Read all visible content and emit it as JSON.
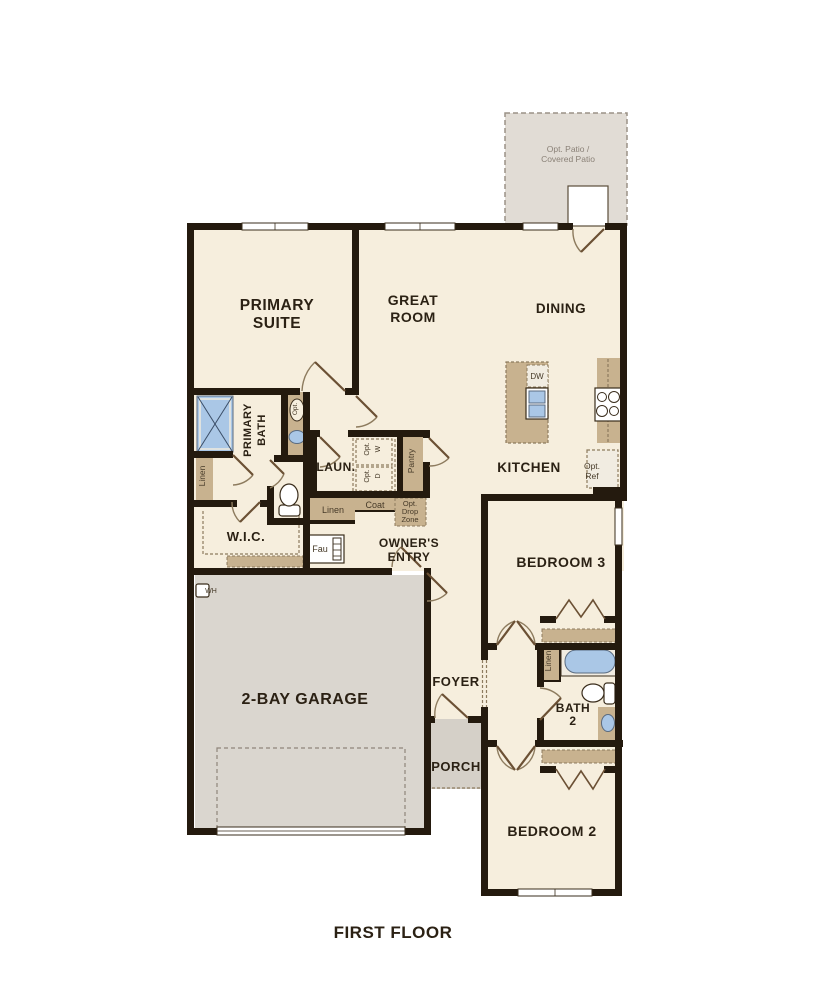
{
  "title": "FIRST FLOOR",
  "colors": {
    "wall": "#241a0e",
    "room_floor": "#f6eedd",
    "garage_floor": "#dad6cf",
    "porch_floor": "#d5d0c8",
    "patio_floor": "#e1dcd5",
    "cabinet_tan": "#c8b28f",
    "fixture_blue": "#aac7e6",
    "label_text": "#2b2114"
  },
  "labels": {
    "patio1": "Opt. Patio /",
    "patio2": "Covered Patio",
    "primary_suite1": "PRIMARY",
    "primary_suite2": "SUITE",
    "great_room1": "GREAT",
    "great_room2": "ROOM",
    "dining": "DINING",
    "kitchen": "KITCHEN",
    "primary_bath1": "PRIMARY",
    "primary_bath2": "BATH",
    "opt_vanity": "Opt.",
    "linen_primary": "Linen",
    "laun": "LAUN.",
    "opt_w1": "Opt.",
    "opt_w2": "W",
    "opt_d1": "Opt.",
    "opt_d2": "D",
    "pantry": "Pantry",
    "linen_hall": "Linen",
    "coat": "Coat",
    "drop1": "Opt.",
    "drop2": "Drop",
    "drop3": "Zone",
    "wic": "W.I.C.",
    "fau": "Fau",
    "owners1": "OWNER'S",
    "owners2": "ENTRY",
    "wh": "WH",
    "garage": "2-BAY GARAGE",
    "foyer": "FOYER",
    "porch": "PORCH",
    "bedroom3": "BEDROOM 3",
    "linen_bath2": "Linen",
    "bath2a": "BATH",
    "bath2b": "2",
    "bedroom2": "BEDROOM 2",
    "dw": "DW",
    "ref1": "Opt.",
    "ref2": "Ref"
  }
}
